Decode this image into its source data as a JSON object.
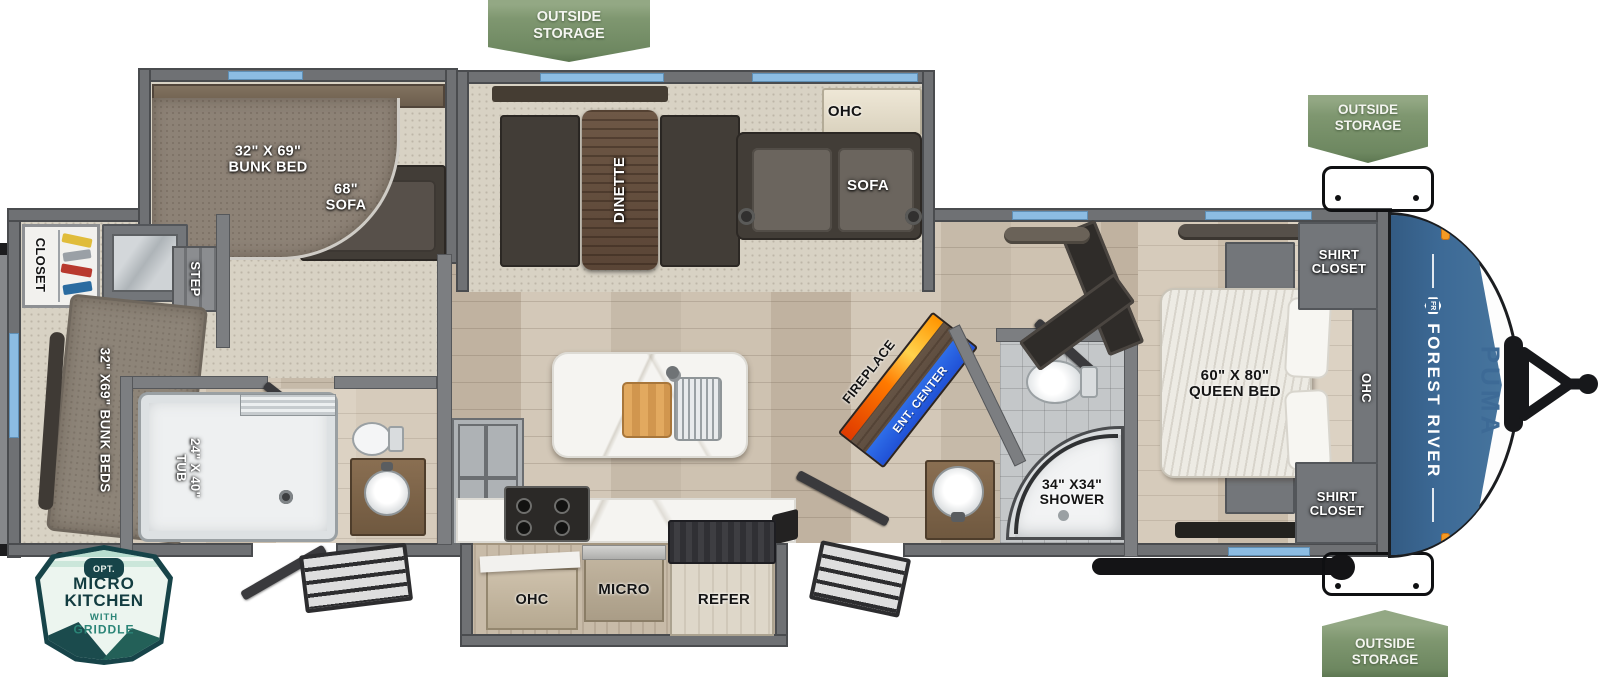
{
  "badges": {
    "outside_storage": "OUTSIDE\nSTORAGE",
    "micro_kitchen": {
      "opt": "OPT.",
      "line1": "MICRO",
      "line2": "KITCHEN",
      "sub1": "WITH",
      "sub2": "GRIDDLE"
    }
  },
  "rooms": {
    "closet": "CLOSET",
    "step": "STEP",
    "rear_bunk_beds": "32\" X69\" BUNK BEDS",
    "tub": "24\" X 40\"\nTUB",
    "bunk_bed": "32\" X 69\"\nBUNK BED",
    "sofa_68": "68\"\nSOFA",
    "dinette": "DINETTE",
    "ohc_sofa": "OHC",
    "sofa": "SOFA",
    "fireplace": "FIREPLACE",
    "ent_center": "ENT. CENTER",
    "shower": "34\" X34\"\nSHOWER",
    "shirt_closet": "SHIRT\nCLOSET",
    "queen_bed": "60\" X 80\"\nQUEEN BED",
    "ohc_bedroom": "OHC",
    "ohc_kitchen": "OHC",
    "micro": "MICRO",
    "refer": "REFER"
  },
  "branding": {
    "make": "FOREST RIVER",
    "model": "PUMA",
    "logo_text": "FR"
  },
  "colors": {
    "badge_green": "#7f9770",
    "cap_blue": "#3d6a96",
    "window_blue": "#8cbce2",
    "fireplace_orange": "#ff7a00",
    "ent_blue": "#2051d6",
    "badge_teal": "#174449"
  }
}
